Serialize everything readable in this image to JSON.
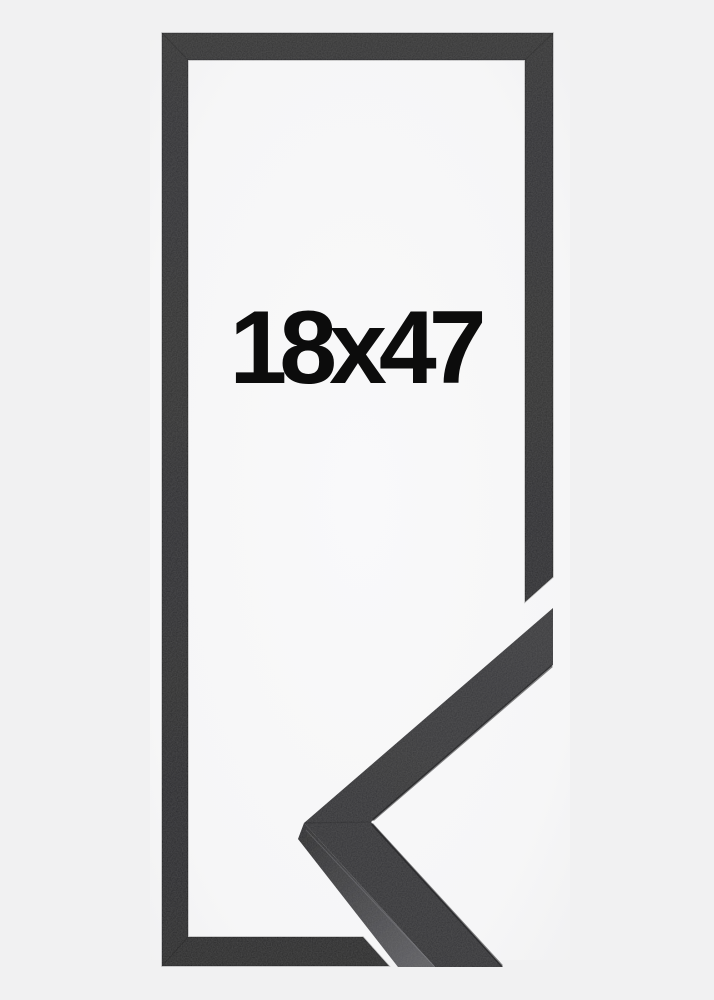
{
  "product": {
    "size_label": "18x47"
  },
  "colors": {
    "background": "#f1f1f2",
    "interior_light": "#fafafb",
    "moulding_top": "#343436",
    "moulding_bottom": "#2a2a2c",
    "sample_face_light": "#3b3b3d",
    "sample_face_dark": "#333336",
    "sample_side_dark": "#2e2e30",
    "sample_side_light": "#5e5e62",
    "edge_shadow": "#1b1b1d",
    "edge_highlight": "#96969c",
    "label_text": "#0c0c0c"
  }
}
